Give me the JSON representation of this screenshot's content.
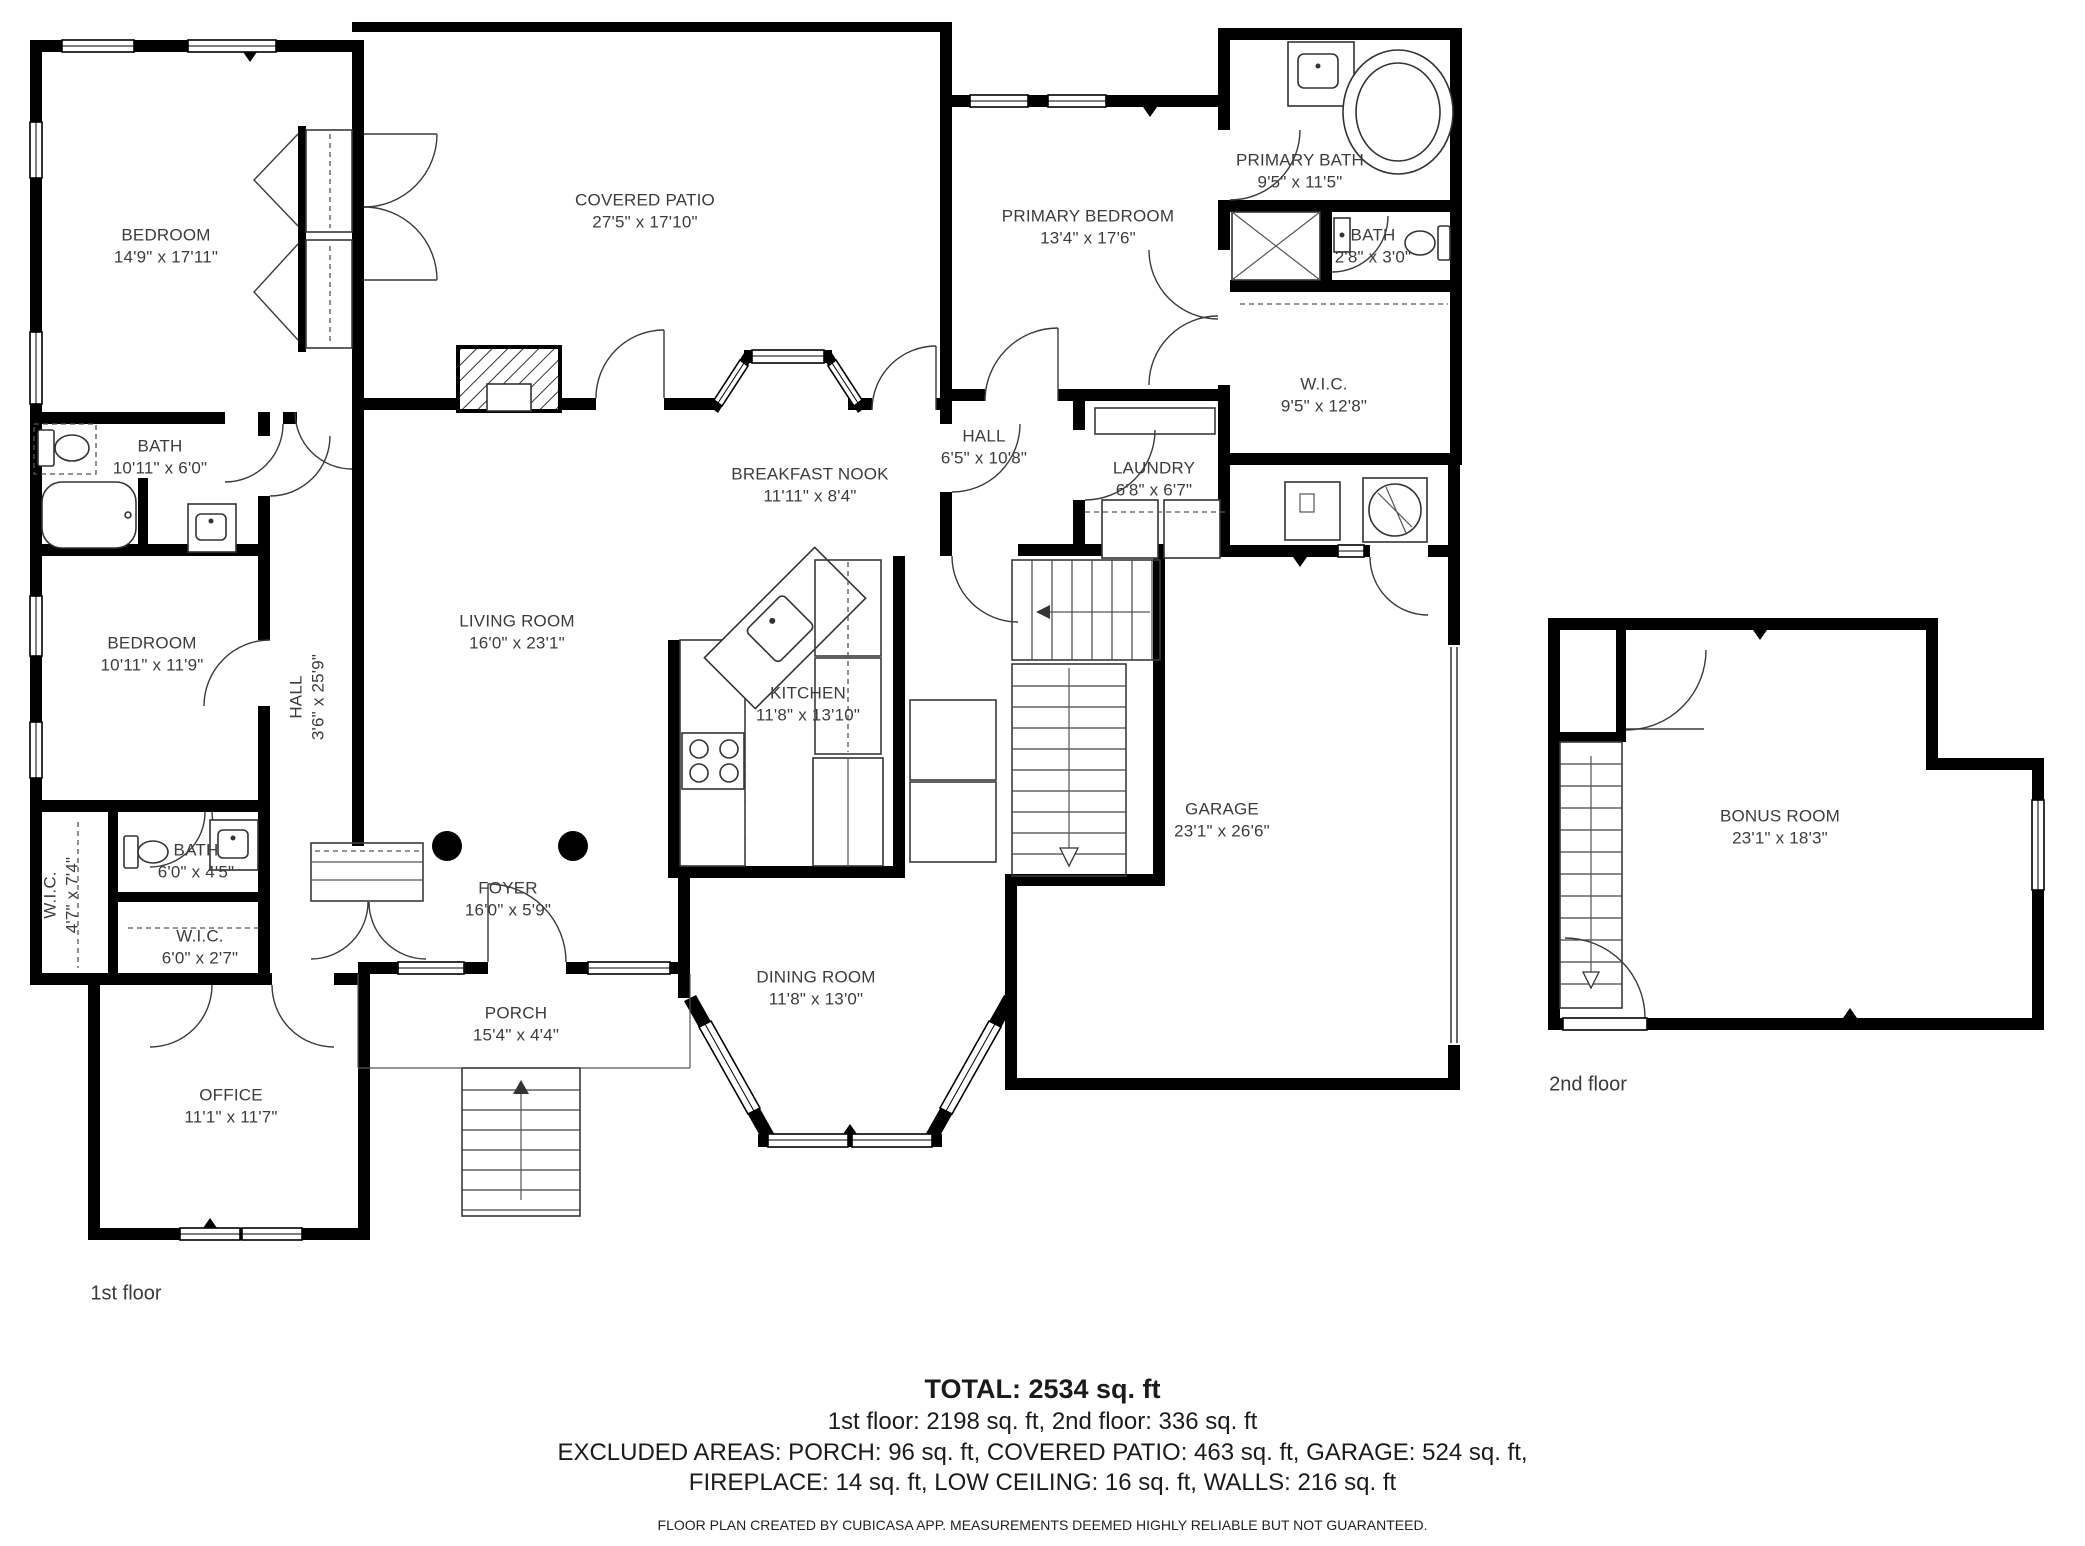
{
  "rooms": [
    {
      "name": "BEDROOM",
      "dims": "14'9\" x 17'11\""
    },
    {
      "name": "COVERED PATIO",
      "dims": "27'5\" x 17'10\""
    },
    {
      "name": "PRIMARY BEDROOM",
      "dims": "13'4\" x 17'6\""
    },
    {
      "name": "PRIMARY BATH",
      "dims": "9'5\" x 11'5\""
    },
    {
      "name": "BATH",
      "dims": "2'8\" x 3'0\""
    },
    {
      "name": "W.I.C.",
      "dims": "9'5\" x 12'8\""
    },
    {
      "name": "BATH",
      "dims": "10'11\" x 6'0\""
    },
    {
      "name": "BREAKFAST NOOK",
      "dims": "11'11\" x 8'4\""
    },
    {
      "name": "HALL",
      "dims": "6'5\" x 10'8\""
    },
    {
      "name": "LAUNDRY",
      "dims": "6'8\" x 6'7\""
    },
    {
      "name": "BEDROOM",
      "dims": "10'11\" x 11'9\""
    },
    {
      "name": "HALL",
      "dims": "3'6\" x 25'9\""
    },
    {
      "name": "LIVING ROOM",
      "dims": "16'0\" x 23'1\""
    },
    {
      "name": "KITCHEN",
      "dims": "11'8\" x 13'10\""
    },
    {
      "name": "GARAGE",
      "dims": "23'1\" x 26'6\""
    },
    {
      "name": "W.I.C.",
      "dims": "4'7\" x 7'4\""
    },
    {
      "name": "BATH",
      "dims": "6'0\" x 4'5\""
    },
    {
      "name": "W.I.C.",
      "dims": "6'0\" x 2'7\""
    },
    {
      "name": "FOYER",
      "dims": "16'0\" x 5'9\""
    },
    {
      "name": "DINING ROOM",
      "dims": "11'8\" x 13'0\""
    },
    {
      "name": "PORCH",
      "dims": "15'4\" x 4'4\""
    },
    {
      "name": "OFFICE",
      "dims": "11'1\" x 11'7\""
    },
    {
      "name": "BONUS ROOM",
      "dims": "23'1\" x 18'3\""
    }
  ],
  "floors": {
    "first": "1st floor",
    "second": "2nd floor"
  },
  "summary": {
    "total": "TOTAL: 2534 sq. ft",
    "floors_line": "1st floor: 2198 sq. ft, 2nd floor: 336 sq. ft",
    "excluded_line1": "EXCLUDED AREAS: PORCH: 96 sq. ft, COVERED PATIO: 463 sq. ft, GARAGE: 524 sq. ft,",
    "excluded_line2": "FIREPLACE: 14 sq. ft, LOW CEILING: 16 sq. ft, WALLS: 216 sq. ft"
  },
  "footer": {
    "disclaimer": "FLOOR PLAN CREATED BY CUBICASA APP. MEASUREMENTS DEEMED HIGHLY RELIABLE BUT NOT GUARANTEED."
  }
}
